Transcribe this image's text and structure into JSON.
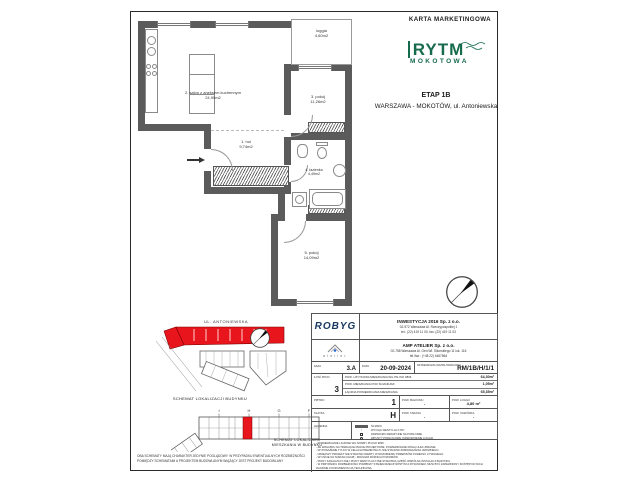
{
  "page": {
    "header": "KARTA MARKETINGOWA"
  },
  "project": {
    "name_top": "RYTM",
    "name_bottom": "MOKOTOWA",
    "stage": "ETAP 1B",
    "address": "WARSZAWA - MOKOTÓW, ul. Antoniewska"
  },
  "floorplan": {
    "rooms": [
      {
        "name": "1. hol",
        "area": "9,74m2"
      },
      {
        "name": "2. salon z aneksem kuchennym",
        "area": "24,90m2"
      },
      {
        "name": "3. pokój",
        "area": "11,26m2"
      },
      {
        "name": "4. łazienka",
        "area": "4,49m2"
      },
      {
        "name": "5. pokój",
        "area": "14,09m2"
      },
      {
        "name": "loggia",
        "area": "4,60m2"
      }
    ]
  },
  "site_schematic": {
    "street": "UL. ANTONIEWSKA",
    "caption": "SCHEMAT LOKALIZACJI BUDYNKU"
  },
  "unit_schematic": {
    "sections": [
      "I",
      "H",
      "G",
      "F"
    ],
    "caption_line1": "SCHEMAT LOKALIZACJI",
    "caption_line2": "MIESZKANIA W BUDYNKU"
  },
  "schematic_note": {
    "line1": "OBA SCHEMATY MAJĄ CHARAKTER JEDYNIE POGLĄDOWY. W PRZYPADKU EWENTUALNYCH ROZBIEŻNOŚCI",
    "line2": "POMIĘDZY SCHEMATAMI A PROJEKTEM BUDOWLANYM WIĄŻĄCY JEST PROJEKT BUDOWLANY"
  },
  "table": {
    "developer": {
      "logo": "ROBYG",
      "name": "INWESTYCJA 2016 Sp. z o.o.",
      "address": "02-972 Warszawa Al. Rzeczypospolitej 1",
      "phone": "tel.: (22) 419 11 00, fax: (22) 419 11 03"
    },
    "architect": {
      "logo": "atelier",
      "name": "AMP ATELIER Sp. z o.o.",
      "address": "02-758 Warszawa  Al. Gen.Wł. Sikorskiego 11 lok. 116",
      "phone": "tel./fax : (+48 22) 4467864"
    },
    "faza_label": "FAZA",
    "faza_value": "3.A",
    "date_label": "DATA",
    "date_value": "20-09-2024",
    "nr_label": "NR MIESZKANIA (NAZWA HANDLOWA)",
    "nr_value": "RM/1B/H/1/1",
    "rooms_label": "ILOŚĆ POKOI",
    "rooms_value": "3",
    "areas": [
      {
        "label": "POW. UŻYTKOWA MIESZKANIA WG PN-ISO 9836",
        "value": "64,30m²"
      },
      {
        "label": "POW. MIESZKANIA POD ŚCIANKAMI",
        "value": "1,05m²"
      },
      {
        "label": "ŁĄCZNA POWIERZCHNIA MIESZKANIA",
        "value": "65,35m²"
      }
    ],
    "floor_label": "PIĘTRO",
    "floor_value": "1",
    "balcony_label": "POW. BALKONU",
    "balcony_value": "-",
    "loggia_label": "POW. LOGGII",
    "loggia_value": "4,80 m²",
    "stair_label": "KLATKA",
    "stair_value": "H",
    "terrace_label": "POW. TARASU",
    "terrace_value": "-",
    "garden_label": "POW. OGRÓDKA",
    "garden_value": "-",
    "legend_label": "LEGENDA",
    "legend": [
      {
        "label": "ŚCIANKI"
      },
      {
        "label": "WYCIĄG WENTYLACYJNY"
      },
      {
        "label": "DRZWICZKI REWIZYJNE NA PODŁODZE"
      },
      {
        "label": "WPUSTY PODŁOGOWE (ODWODNIENIE LOGGII)"
      }
    ],
    "disclaimer": [
      "- POWIERZCHNIE LICZONE WG NORMY PN-ISO 9836.",
      "- ZE WZGLĘDU NA TRWAJĄCE PRACE PROJEKTOWE, POWIERZCHNIE MOGĄ ULEC ZMIANIE.",
      "- WYPOSAŻENIE TYLKO W CELACH PREZENTACJI, NIE STANOWI ZOBOWIĄZANIA UMOWNEGO.",
      "- NINIEJSZY PROJEKT NIE STANOWI OFERTY W ROZUMIENIU PRZEPISÓW KODEKSU CYWILNEGO.",
      "- WYJŚCIE NA TARAS/LOGGIĘ - MOŻLIWA RÓŻNICA POZIOMÓW.",
      "- PIONY KANALIZACYJNE I PIONY WENTYLACYJNE STANOWIĄ CZĘŚĆ WSPÓLNĄ INSTALACJI BUDYNKU.",
      "- W PRZYPADKU ROZBIEŻNOŚCI POMIĘDZY STANEM RZECZYWISTYM A RYSUNKIEM, MUSI BYĆ ZAPEWNIONY DOSTĘP DO NICH ZGODNIE Z DOKUMENTACJĄ TECHNICZNĄ."
    ]
  },
  "colors": {
    "accent_red": "#e8151c",
    "brand_green": "#176b4d",
    "robyg_navy": "#17375e"
  }
}
